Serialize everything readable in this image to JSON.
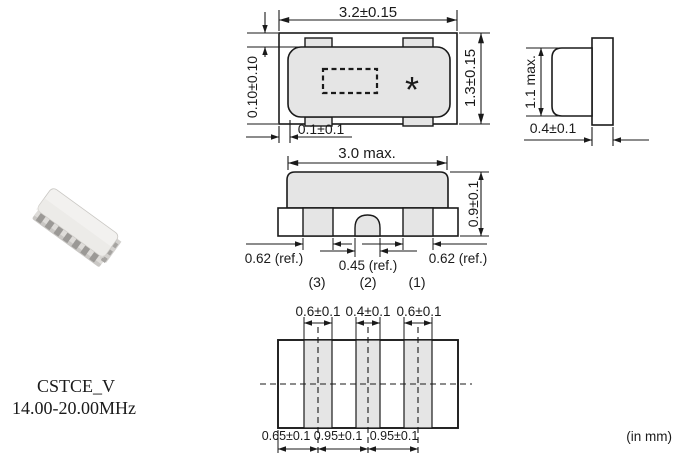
{
  "product": {
    "series_label": "CSTCE_V",
    "frequency_label": "14.00-20.00MHz"
  },
  "units_label": "(in mm)",
  "top_view": {
    "dim_width": "3.2±0.15",
    "dim_height": "1.3±0.15",
    "dim_cap_clearance_vertical": "0.10±0.10",
    "dim_cap_clearance_horizontal": "0.1±0.1",
    "marking": "*"
  },
  "side_view": {
    "dim_height": "1.1 max.",
    "dim_substrate_thickness": "0.4±0.1"
  },
  "front_view": {
    "dim_cap_width": "3.0 max.",
    "dim_height": "0.9±0.1",
    "dim_outer_electrode_left": "0.62 (ref.)",
    "dim_center_electrode": "0.45 (ref.)",
    "dim_outer_electrode_right": "0.62 (ref.)",
    "terminal_left": "(3)",
    "terminal_center": "(2)",
    "terminal_right": "(1)"
  },
  "bottom_view": {
    "dim_electrode1_width": "0.6±0.1",
    "dim_electrode2_width": "0.4±0.1",
    "dim_electrode3_width": "0.6±0.1",
    "dim_edge_to_center1": "0.65±0.1",
    "dim_center1_to_center2": "0.95±0.1",
    "dim_center2_to_center3": "0.95±0.1"
  },
  "colors": {
    "line": "#1a1a1a",
    "fill_gray": "#e5e5e5",
    "background": "#ffffff"
  }
}
